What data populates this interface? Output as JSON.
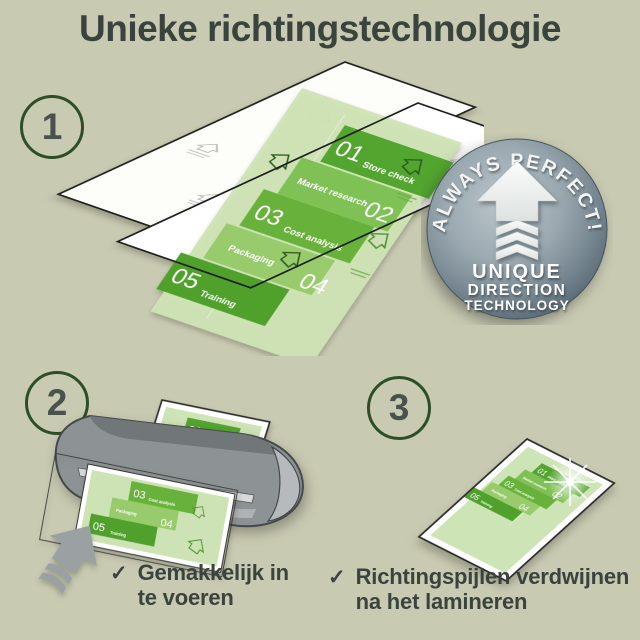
{
  "title": "Unieke richtingstechnologie",
  "steps": {
    "one": "1",
    "two": "2",
    "three": "3"
  },
  "doc": {
    "launch": "Launch",
    "bands": [
      {
        "num": "01",
        "label": "Store check"
      },
      {
        "num": "02",
        "label": "Market research"
      },
      {
        "num": "03",
        "label": "Cost analysis"
      },
      {
        "num": "04",
        "label": "Packaging"
      },
      {
        "num": "05",
        "label": "Training"
      }
    ]
  },
  "badge": {
    "arc": "ALWAYS PERFECT!",
    "line1": "UNIQUE",
    "line2": "DIRECTION",
    "line3": "TECHNOLOGY"
  },
  "checklist": {
    "check_glyph": "✓",
    "items": [
      {
        "line1": "Gemakkelijk in",
        "line2": "te voeren"
      },
      {
        "line1": "Richtingspijlen verdwijnen",
        "line2": "na het lamineren"
      }
    ]
  },
  "colors": {
    "background": "#c9cab2",
    "text": "#3a433e",
    "circle_border": "#2d4e27",
    "green_dark": "#52a52e",
    "green_mid": "#7fc155",
    "green_alt": "#68b23c",
    "green_light": "#97cb6b",
    "page_green": "#cfe4b6",
    "badge_light": "#bcc6cb",
    "badge_edge": "#4f6069",
    "laminator_gray": "#8d9395",
    "feed_arrow_gray": "#9ba0a2"
  }
}
